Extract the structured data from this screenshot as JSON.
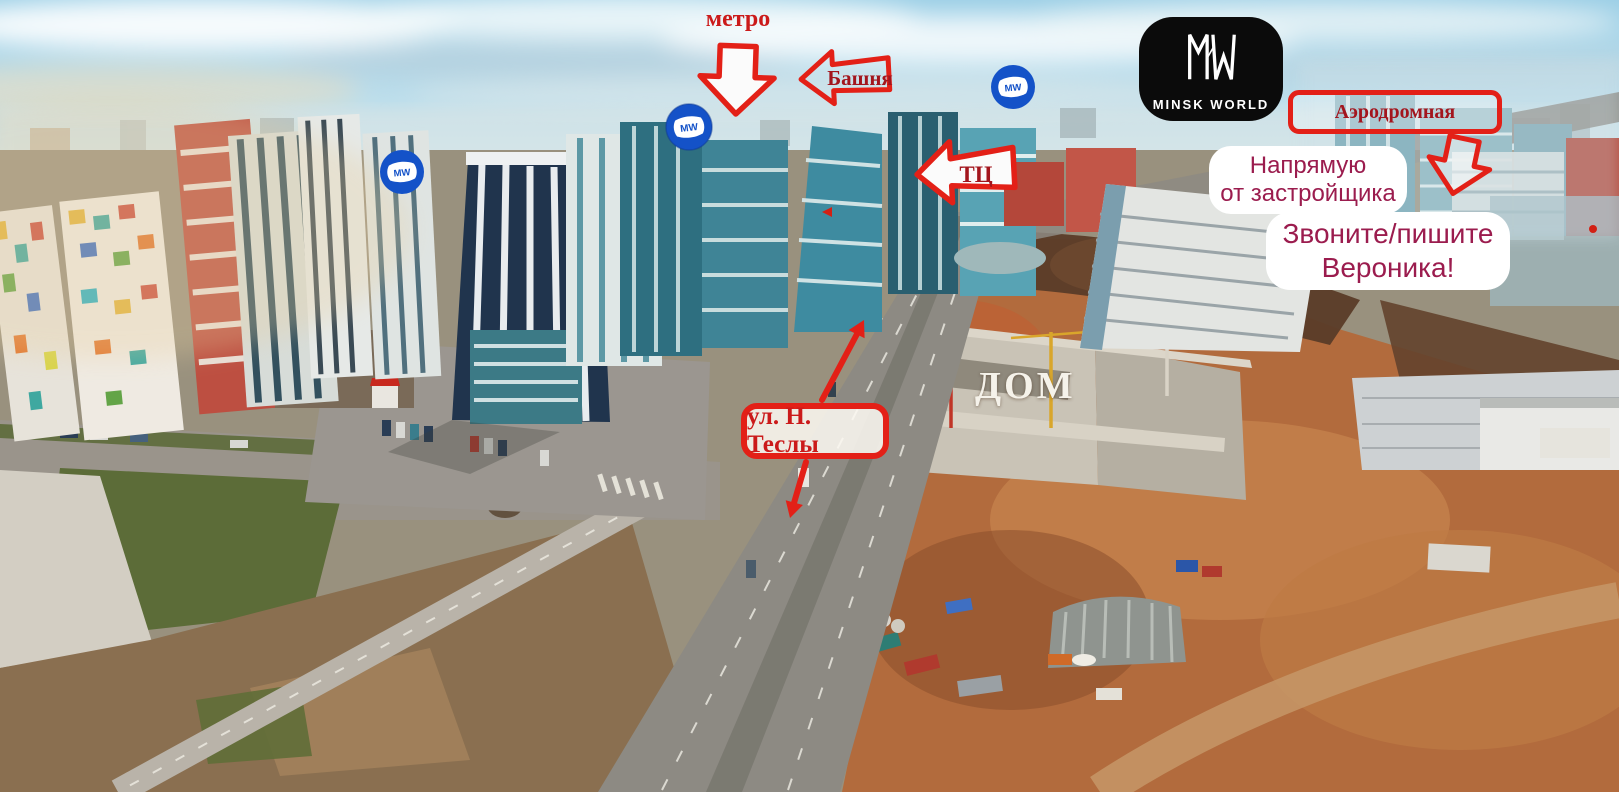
{
  "colors": {
    "arrow_red": "#e32017",
    "dark_label_red": "#a3151d",
    "bright_label_red": "#cb1a1a",
    "maroon_text": "#9b1c4e",
    "marker_blue": "#1452c8",
    "logo_black": "#0b0b0b",
    "dom_white": "#f5f2ea"
  },
  "labels": {
    "metro": "метро",
    "tower": "Башня",
    "mall": "ТЦ",
    "street_sign": "Аэродромная",
    "tesla_street": "ул. Н. Теслы",
    "house": "ДОМ"
  },
  "logo": {
    "caption": "MINSK WORLD"
  },
  "markers": {
    "monogram": "MW"
  },
  "developer_box": {
    "line1": "Напрямую",
    "line2": "от застройщика"
  },
  "contact_box": {
    "line1": "Звоните/пишите",
    "line2": "Вероника!"
  }
}
